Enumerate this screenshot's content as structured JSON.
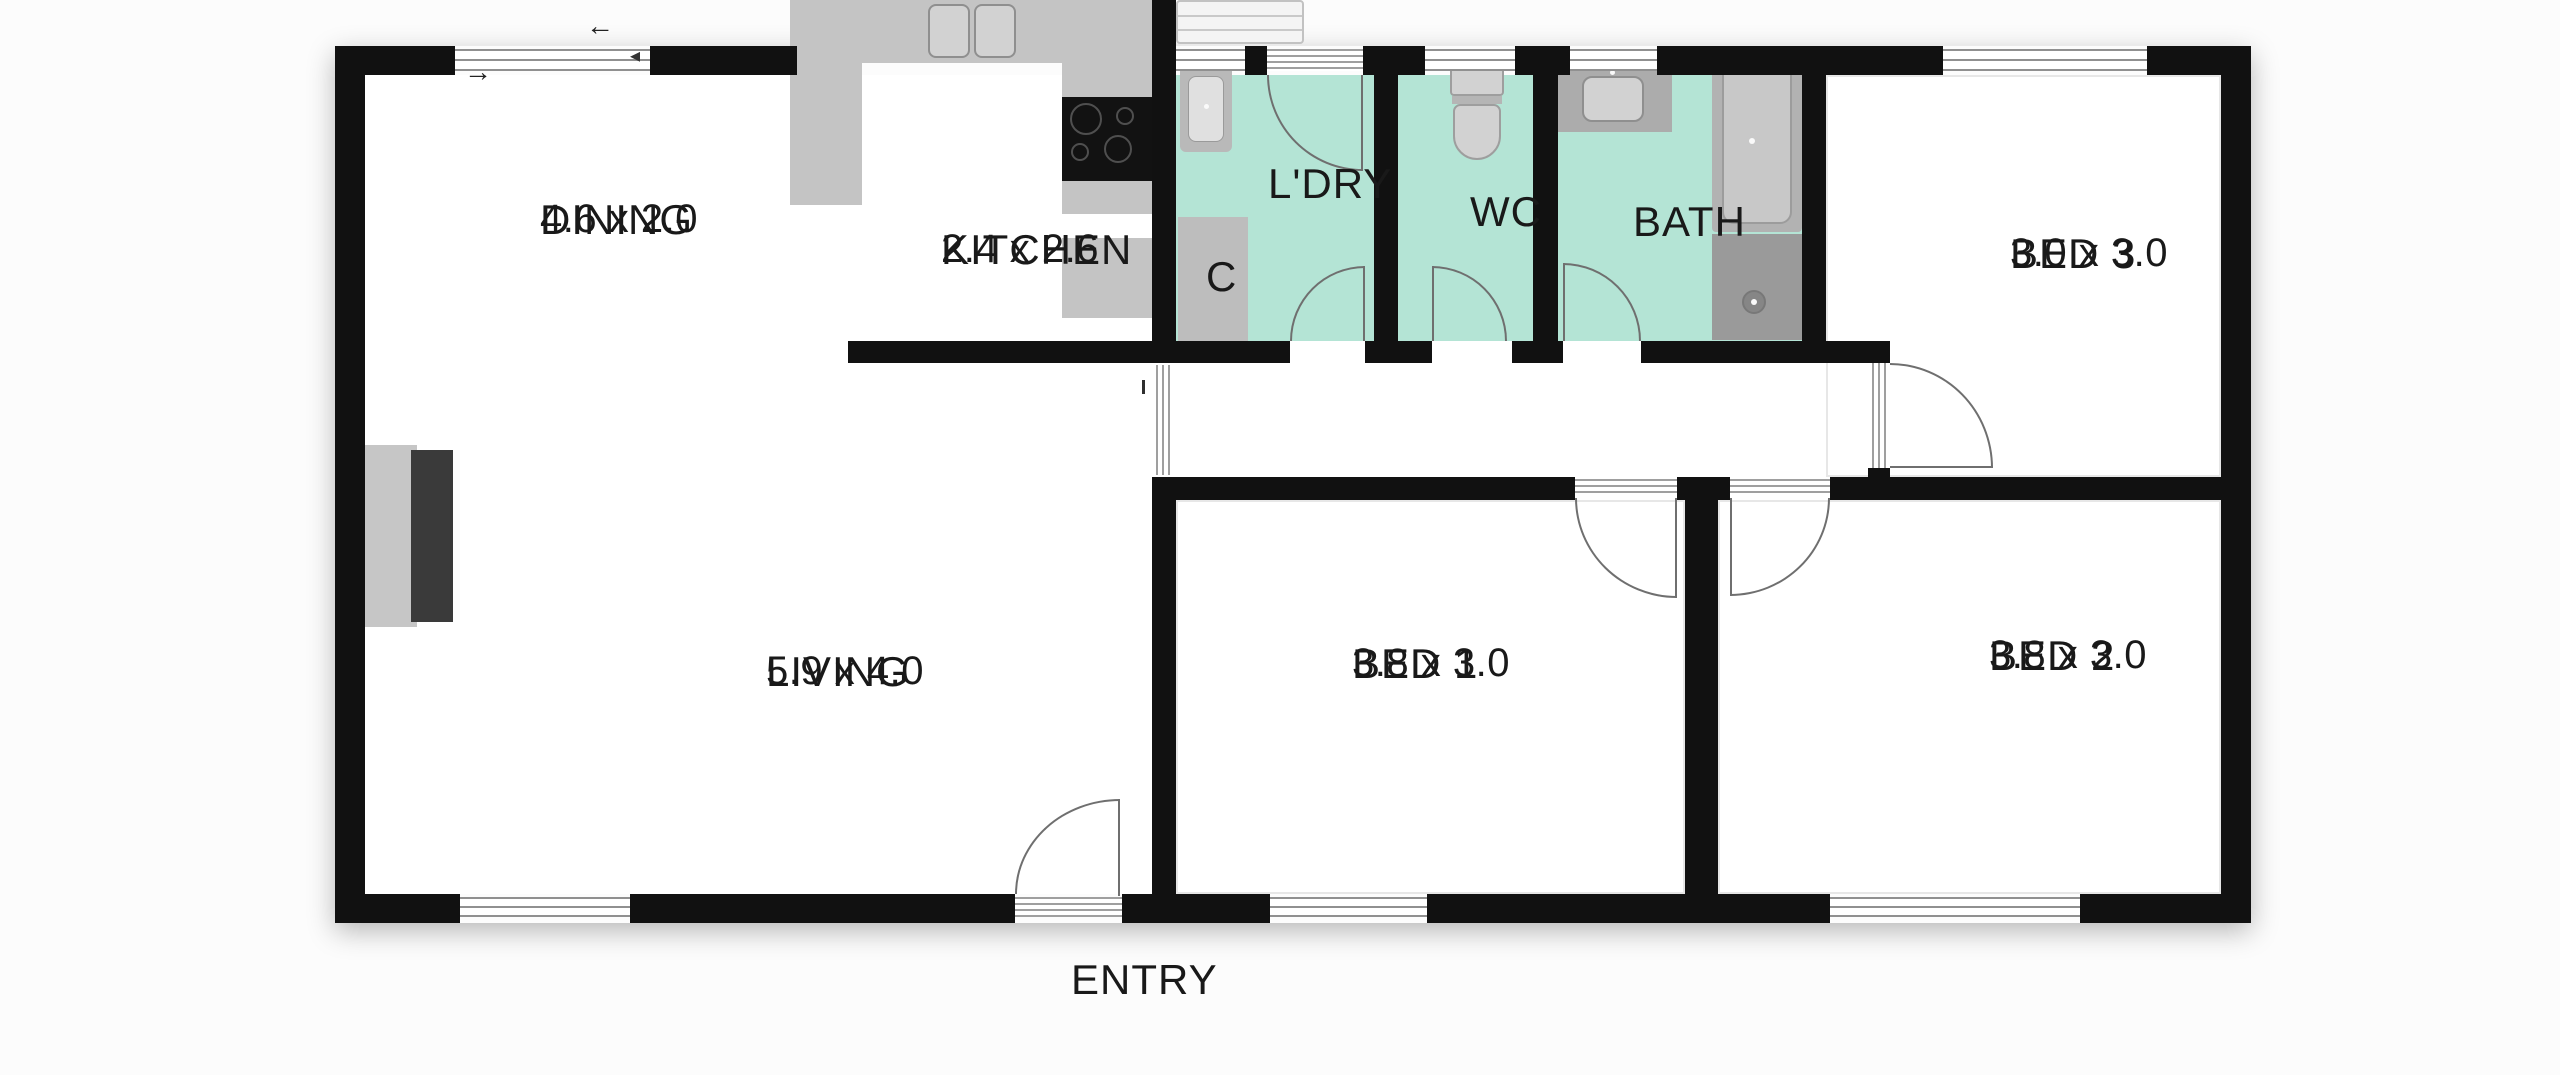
{
  "title": "residential floor plan",
  "colors": {
    "bg": "#fcfcfc",
    "floor": "#ffffff",
    "wall": "#111111",
    "wet": "#b4e4d5",
    "fix_mid": "#c4c4c4",
    "fix_deep": "#acacac",
    "fix_light": "#d2d2d2",
    "appliance_dark": "#121212",
    "shower_gray": "#9a9a9a",
    "fireplace_dark": "#3a3a3a",
    "door": "#6f6f6f",
    "window_line": "#909090",
    "text": "#191919"
  },
  "rooms": {
    "dining": {
      "name": "DINING",
      "dims": "4.6 x 2.0"
    },
    "kitchen": {
      "name": "KITCHEN",
      "dims": "2.4 x 2.6"
    },
    "laundry": {
      "name": "L'DRY"
    },
    "cupboard": {
      "name": "C"
    },
    "wc": {
      "name": "WC"
    },
    "bath": {
      "name": "BATH"
    },
    "bed3": {
      "name": "BED 3",
      "dims": "3.0 x 3.0"
    },
    "living": {
      "name": "LIVING",
      "dims": "5.9 x 4.0"
    },
    "bed1": {
      "name": "BED 1",
      "dims": "3.8 x 3.0"
    },
    "bed2": {
      "name": "BED 2",
      "dims": "3.8 x 3.0"
    },
    "entry": {
      "name": "ENTRY"
    }
  },
  "symbols": {
    "slide_arrow_left": "←",
    "slide_arrow_right": "→",
    "sash_arrow": "◂"
  }
}
